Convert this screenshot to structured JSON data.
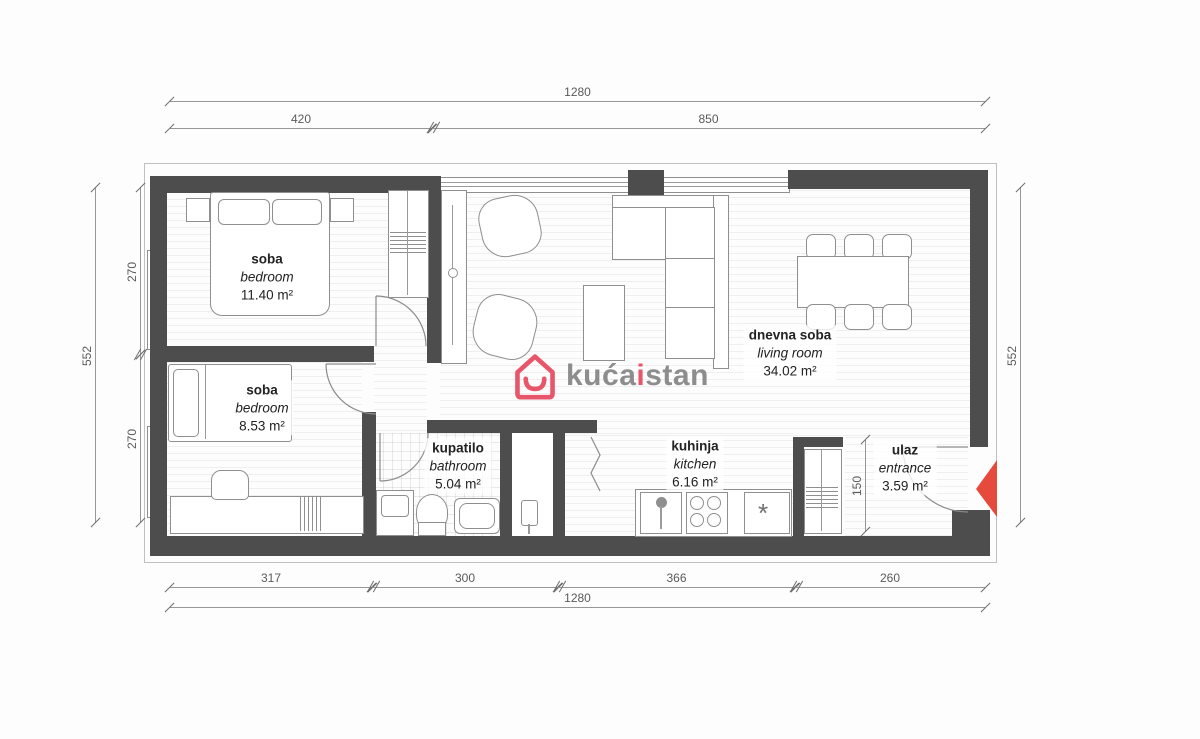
{
  "rooms": [
    {
      "id": "bedroom-1",
      "name_sr": "soba",
      "name_en": "bedroom",
      "area": "11.40 m²"
    },
    {
      "id": "bedroom-2",
      "name_sr": "soba",
      "name_en": "bedroom",
      "area": "8.53 m²"
    },
    {
      "id": "bathroom",
      "name_sr": "kupatilo",
      "name_en": "bathroom",
      "area": "5.04 m²"
    },
    {
      "id": "kitchen",
      "name_sr": "kuhinja",
      "name_en": "kitchen",
      "area": "6.16 m²"
    },
    {
      "id": "living",
      "name_sr": "dnevna soba",
      "name_en": "living room",
      "area": "34.02 m²"
    },
    {
      "id": "entrance",
      "name_sr": "ulaz",
      "name_en": "entrance",
      "area": "3.59 m²"
    }
  ],
  "dimensions": {
    "top_total": "1280",
    "top_left": "420",
    "top_right": "850",
    "left_total": "552",
    "left_upper": "270",
    "left_lower": "270",
    "right_total": "552",
    "bottom_a": "317",
    "bottom_b": "300",
    "bottom_c": "366",
    "bottom_d": "260",
    "bottom_total": "1280",
    "entrance_depth": "150"
  },
  "logo": {
    "text_main": "kuća",
    "text_accent": "i",
    "text_suffix": "stan"
  },
  "icons": {
    "kitchen_gas_symbol": "*"
  },
  "colors": {
    "wall": "#4d4d4d",
    "dimension_line": "#979797",
    "entrance_arrow": "#e64a3c",
    "logo_accent": "#e8566b",
    "logo_gray": "#8d8d8d"
  }
}
